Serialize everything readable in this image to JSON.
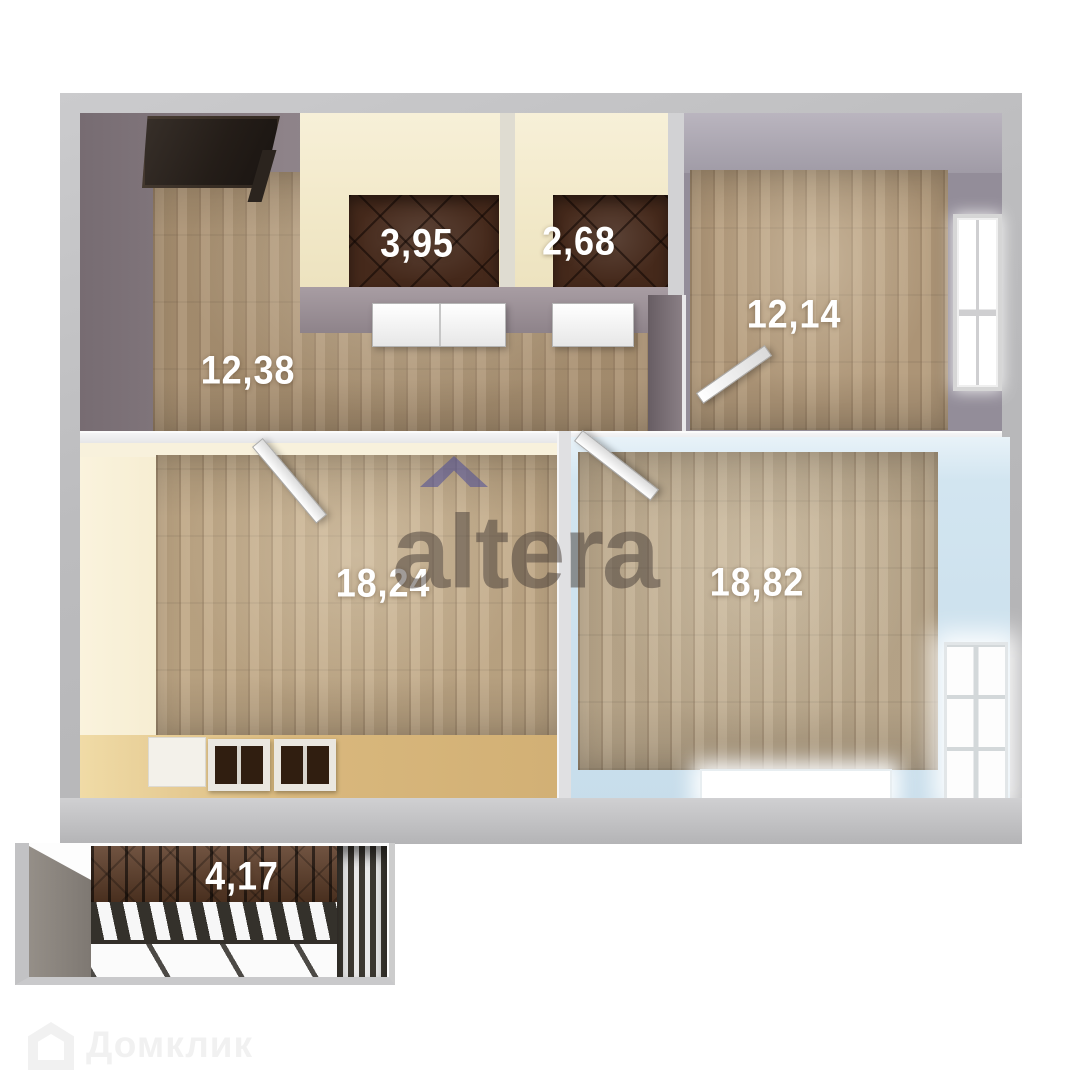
{
  "watermarks": {
    "altera": {
      "text": "altera",
      "text_color": "#4a403b",
      "chevron_icon": "chevron-up",
      "chevron_color": "#504f96"
    },
    "domklik": {
      "text": "Домклик",
      "color": "#f1f1f1",
      "icon": "house"
    }
  },
  "rooms": [
    {
      "id": "hallway",
      "area_sqm": "12,38"
    },
    {
      "id": "bathroom",
      "area_sqm": "3,95"
    },
    {
      "id": "toilet",
      "area_sqm": "2,68"
    },
    {
      "id": "bedroom-top-right",
      "area_sqm": "12,14"
    },
    {
      "id": "living-room-left",
      "area_sqm": "18,24"
    },
    {
      "id": "living-room-right",
      "area_sqm": "18,82"
    },
    {
      "id": "balcony",
      "area_sqm": "4,17"
    }
  ],
  "palette": {
    "outer_wall": "#bcbcbe",
    "hallway_wall": "#8e8389",
    "bathroom_wall": "#f2e9c9",
    "bathroom_floor_tile": "#45291b",
    "bedroom_wall": "#938d99",
    "kitchen_wall": "#f1e5c2",
    "bedroom2_wall": "#cfe3ee",
    "wood_floor": "#b29877",
    "kitchen_counter": "#d9b87d",
    "balcony_wood": "#5d3c27",
    "label_text": "#ffffff"
  }
}
